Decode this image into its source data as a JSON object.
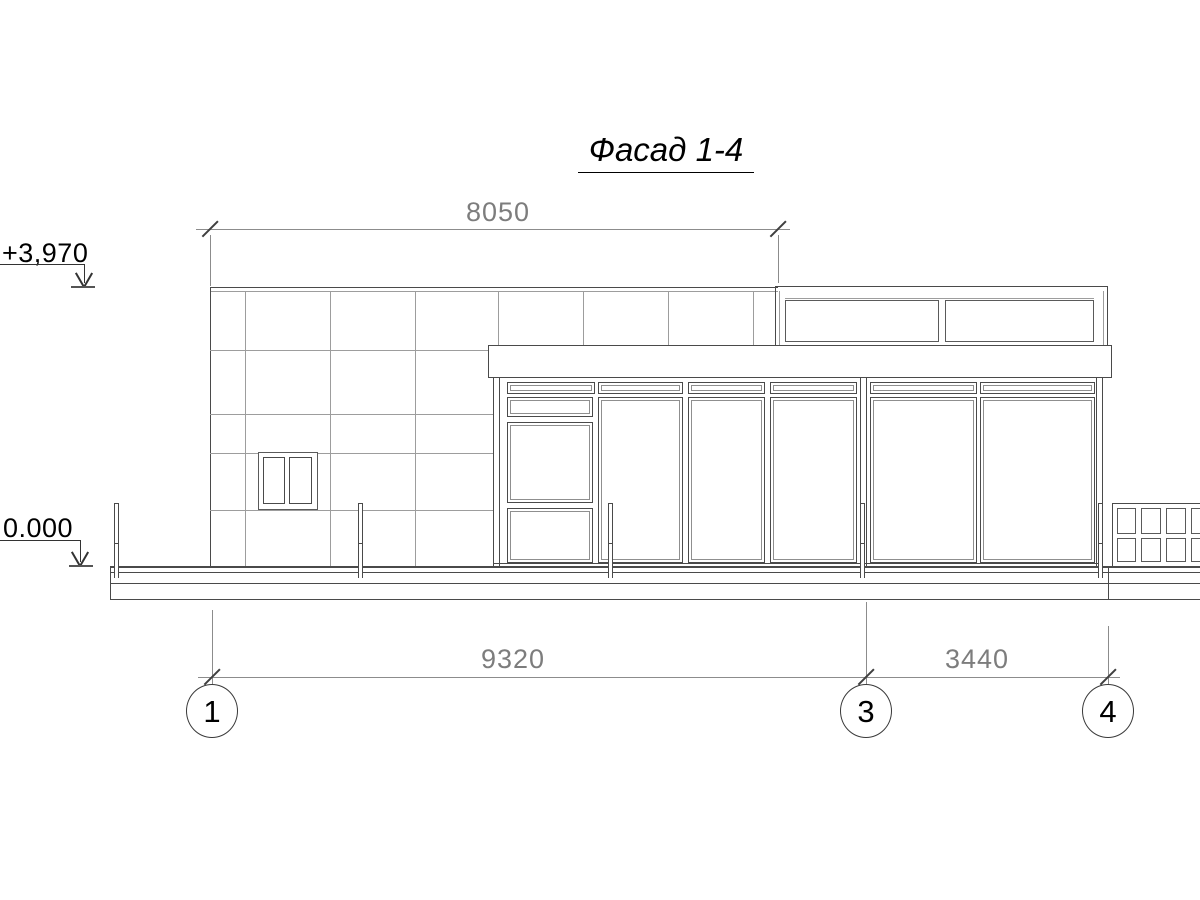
{
  "title": {
    "text": "Фасад 1-4"
  },
  "dimensions": {
    "top": {
      "label": "8050"
    },
    "bottom_left": {
      "label": "9320"
    },
    "bottom_right": {
      "label": "3440"
    }
  },
  "elevations": {
    "roof": {
      "label": "+3,970"
    },
    "ground": {
      "label": "0.000"
    }
  },
  "axes": [
    {
      "label": "1"
    },
    {
      "label": "3"
    },
    {
      "label": "4"
    }
  ],
  "colors": {
    "background": "#ffffff",
    "line_dark": "#4a4a4a",
    "line_light": "#9d9d9d",
    "dimension_line": "#8c8c8c",
    "dimension_text": "#7d7d7d",
    "text": "#000000"
  }
}
